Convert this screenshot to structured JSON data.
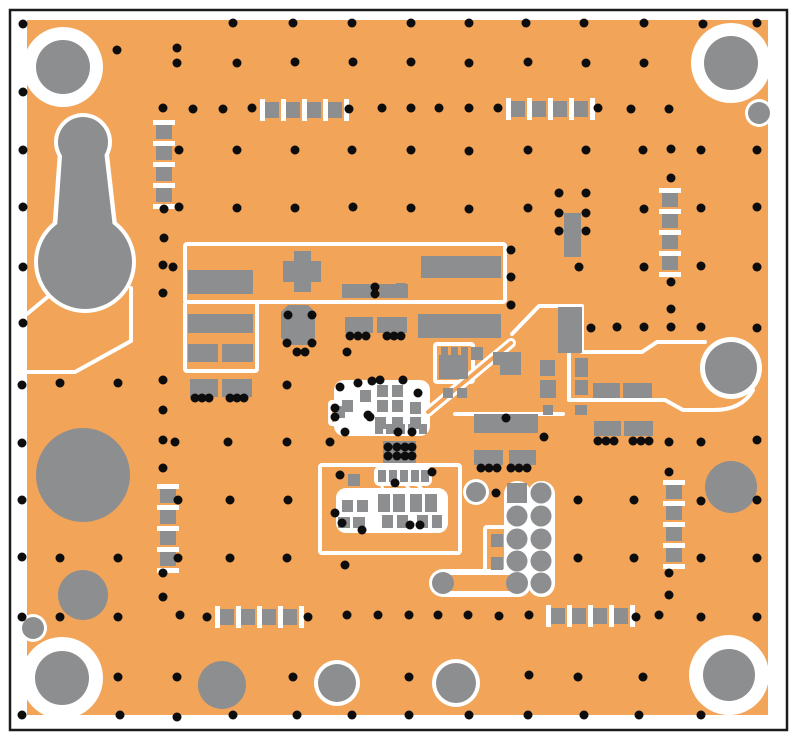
{
  "figure": {
    "kind": "pcb-layout-top-view",
    "width": 796,
    "height": 741
  },
  "colors": {
    "page_bg": "#ffffff",
    "frame": "#1b1b1b",
    "board": "#f2a459",
    "pad": "#8d8e90",
    "silk": "#ffffff",
    "drill": "#0d0d0d"
  },
  "frame": {
    "x": 10,
    "y": 10,
    "w": 777,
    "h": 720
  },
  "board": {
    "x": 27,
    "y": 20,
    "w": 741,
    "h": 695
  },
  "mount_holes": [
    [
      63,
      67,
      27,
      13
    ],
    [
      731,
      63,
      27,
      13
    ],
    [
      62,
      678,
      27,
      14
    ],
    [
      729,
      675,
      26,
      14
    ]
  ],
  "ringed_circles": [
    [
      759,
      113,
      11,
      3
    ],
    [
      33,
      628,
      11,
      3
    ],
    [
      337,
      683,
      19,
      4
    ],
    [
      456,
      683,
      20,
      4
    ],
    [
      476,
      492,
      10,
      3
    ],
    [
      731,
      368,
      26,
      5
    ]
  ],
  "plain_circles": [
    [
      83,
      475,
      47
    ],
    [
      83,
      595,
      25
    ],
    [
      222,
      685,
      24
    ],
    [
      731,
      487,
      26
    ]
  ],
  "teardrop": {
    "small": [
      83,
      142,
      25
    ],
    "big": [
      85,
      262,
      47
    ],
    "stem": "63,142 103,142 113,228 57,228",
    "stem_white": "59,137 107,137 118,233 52,233",
    "tails": [
      "M131,288 L131,341 L75,372 L27,372",
      "M56,290 L27,314"
    ]
  },
  "silk_boxes": [
    [
      185,
      244,
      320,
      58
    ],
    [
      185,
      302,
      72,
      69
    ],
    [
      320,
      465,
      140,
      88
    ],
    [
      485,
      527,
      24,
      51
    ],
    [
      330,
      402,
      22,
      22
    ],
    [
      435,
      344,
      38,
      38
    ]
  ],
  "silk_paths": [
    {
      "d": "M512,334 L539,306 L582,306 L582,352 L642,352 L657,342 L705,342",
      "w": 4
    },
    {
      "d": "M569,354 L569,400 L665,400 L683,410 L714,410 Q742,410 753,390",
      "w": 4
    },
    {
      "d": "M455,414 L563,414",
      "w": 4
    },
    {
      "d": "M381,482 L384,495",
      "w": 3
    },
    {
      "d": "M392,482 L399,495",
      "w": 3
    },
    {
      "d": "M403,482 L415,495",
      "w": 3
    },
    {
      "d": "M414,482 L429,495",
      "w": 3
    }
  ],
  "white_blobs": [
    [
      334,
      380,
      96,
      56,
      10
    ],
    [
      336,
      488,
      112,
      45,
      10
    ],
    [
      374,
      466,
      58,
      20,
      6
    ],
    [
      504,
      481,
      27,
      116,
      13
    ],
    [
      528,
      481,
      27,
      116,
      13
    ]
  ],
  "trace_outline": {
    "d": "M428,412 L511,343",
    "outer": 10,
    "inner": 4
  },
  "dumbbell": {
    "x1": 443,
    "y1": 583,
    "x2": 517,
    "y2": 583,
    "outer": 28,
    "inner": 16,
    "end_r": 11
  },
  "octagon": "288,305 308,305 315,312 315,338 308,345 288,345 281,338 281,312",
  "pads": [
    [
      188,
      270,
      65,
      24
    ],
    [
      283,
      261,
      38,
      21
    ],
    [
      294,
      251,
      17,
      41
    ],
    [
      342,
      284,
      30,
      14
    ],
    [
      379,
      284,
      29,
      14
    ],
    [
      421,
      256,
      80,
      22
    ],
    [
      188,
      314,
      65,
      19
    ],
    [
      188,
      344,
      30,
      18
    ],
    [
      222,
      344,
      31,
      18
    ],
    [
      190,
      379,
      28,
      18
    ],
    [
      222,
      379,
      30,
      18
    ],
    [
      345,
      317,
      28,
      16
    ],
    [
      377,
      317,
      30,
      16
    ],
    [
      418,
      314,
      83,
      24
    ],
    [
      396,
      283,
      10,
      15
    ],
    [
      396,
      318,
      10,
      14
    ],
    [
      439,
      355,
      29,
      24
    ],
    [
      441,
      347,
      7,
      9
    ],
    [
      451,
      347,
      7,
      9
    ],
    [
      461,
      347,
      7,
      9
    ],
    [
      471,
      347,
      12,
      13
    ],
    [
      493,
      352,
      23,
      13
    ],
    [
      558,
      307,
      24,
      46
    ],
    [
      500,
      352,
      21,
      23
    ],
    [
      540,
      360,
      15,
      16
    ],
    [
      540,
      380,
      16,
      18
    ],
    [
      543,
      405,
      10,
      10
    ],
    [
      575,
      358,
      13,
      19
    ],
    [
      575,
      380,
      13,
      15
    ],
    [
      575,
      405,
      12,
      10
    ],
    [
      593,
      383,
      27,
      15
    ],
    [
      623,
      383,
      29,
      15
    ],
    [
      594,
      421,
      27,
      15
    ],
    [
      624,
      421,
      29,
      15
    ],
    [
      474,
      414,
      64,
      19
    ],
    [
      474,
      450,
      29,
      15
    ],
    [
      509,
      450,
      27,
      15
    ],
    [
      383,
      441,
      33,
      22
    ],
    [
      564,
      213,
      17,
      44
    ],
    [
      360,
      390,
      11,
      12
    ],
    [
      377,
      385,
      11,
      12
    ],
    [
      392,
      385,
      11,
      12
    ],
    [
      342,
      400,
      11,
      12
    ],
    [
      377,
      400,
      11,
      12
    ],
    [
      392,
      400,
      11,
      12
    ],
    [
      410,
      402,
      11,
      12
    ],
    [
      375,
      417,
      11,
      12
    ],
    [
      392,
      417,
      11,
      12
    ],
    [
      410,
      417,
      11,
      12
    ],
    [
      334,
      406,
      11,
      12
    ],
    [
      375,
      424,
      8,
      10
    ],
    [
      386,
      424,
      8,
      10
    ],
    [
      397,
      424,
      8,
      10
    ],
    [
      408,
      424,
      8,
      10
    ],
    [
      419,
      424,
      8,
      10
    ],
    [
      378,
      470,
      8,
      12
    ],
    [
      389,
      470,
      8,
      12
    ],
    [
      400,
      470,
      8,
      12
    ],
    [
      411,
      470,
      8,
      12
    ],
    [
      421,
      470,
      8,
      12
    ],
    [
      348,
      474,
      12,
      12
    ],
    [
      342,
      500,
      11,
      12
    ],
    [
      357,
      500,
      11,
      12
    ],
    [
      378,
      494,
      12,
      18
    ],
    [
      393,
      494,
      12,
      18
    ],
    [
      410,
      494,
      12,
      18
    ],
    [
      425,
      494,
      12,
      18
    ],
    [
      382,
      515,
      11,
      13
    ],
    [
      397,
      515,
      11,
      13
    ],
    [
      417,
      515,
      11,
      13
    ],
    [
      432,
      515,
      10,
      13
    ],
    [
      338,
      517,
      12,
      11
    ],
    [
      353,
      517,
      12,
      11
    ],
    [
      491,
      534,
      12,
      13
    ],
    [
      491,
      557,
      12,
      13
    ],
    [
      443,
      388,
      10,
      10
    ],
    [
      457,
      388,
      10,
      10
    ]
  ],
  "chains": [
    {
      "x": 156,
      "y": 120,
      "o": "v"
    },
    {
      "x": 260,
      "y": 102,
      "o": "h"
    },
    {
      "x": 506,
      "y": 101,
      "o": "h"
    },
    {
      "x": 662,
      "y": 188,
      "o": "v"
    },
    {
      "x": 160,
      "y": 484,
      "o": "v"
    },
    {
      "x": 666,
      "y": 480,
      "o": "v"
    },
    {
      "x": 215,
      "y": 609,
      "o": "h"
    },
    {
      "x": 546,
      "y": 608,
      "o": "h"
    }
  ],
  "chain_style": {
    "step": 21,
    "pad_long": 14,
    "pad_short": 16,
    "tick_long": 22,
    "tick_short": 5,
    "count": 4
  },
  "header": {
    "square": [
      507,
      483,
      20,
      20
    ],
    "col_left_x": 517,
    "rows_left": [
      516,
      539,
      561,
      583
    ],
    "col_right_x": 541,
    "rows_right": [
      493,
      516,
      539,
      561,
      583
    ],
    "r": 10.5
  },
  "vias": {
    "r": 4.5,
    "pts": [
      [
        23,
        24
      ],
      [
        233,
        23
      ],
      [
        293,
        23
      ],
      [
        352,
        23
      ],
      [
        411,
        23
      ],
      [
        469,
        23
      ],
      [
        526,
        23
      ],
      [
        584,
        23
      ],
      [
        644,
        23
      ],
      [
        703,
        24
      ],
      [
        757,
        23
      ],
      [
        117,
        50
      ],
      [
        177,
        48
      ],
      [
        177,
        63
      ],
      [
        237,
        63
      ],
      [
        295,
        62
      ],
      [
        353,
        62
      ],
      [
        411,
        62
      ],
      [
        469,
        63
      ],
      [
        528,
        62
      ],
      [
        586,
        63
      ],
      [
        644,
        63
      ],
      [
        23,
        92
      ],
      [
        163,
        108
      ],
      [
        193,
        109
      ],
      [
        223,
        109
      ],
      [
        252,
        108
      ],
      [
        349,
        109
      ],
      [
        382,
        108
      ],
      [
        411,
        108
      ],
      [
        439,
        108
      ],
      [
        469,
        108
      ],
      [
        498,
        108
      ],
      [
        598,
        108
      ],
      [
        631,
        109
      ],
      [
        669,
        109
      ],
      [
        23,
        150
      ],
      [
        179,
        150
      ],
      [
        237,
        150
      ],
      [
        295,
        150
      ],
      [
        352,
        150
      ],
      [
        411,
        150
      ],
      [
        469,
        151
      ],
      [
        528,
        150
      ],
      [
        586,
        150
      ],
      [
        643,
        150
      ],
      [
        671,
        149
      ],
      [
        701,
        150
      ],
      [
        757,
        150
      ],
      [
        671,
        178
      ],
      [
        23,
        207
      ],
      [
        164,
        209
      ],
      [
        179,
        207
      ],
      [
        237,
        208
      ],
      [
        295,
        208
      ],
      [
        353,
        207
      ],
      [
        411,
        208
      ],
      [
        469,
        209
      ],
      [
        528,
        208
      ],
      [
        644,
        209
      ],
      [
        701,
        208
      ],
      [
        757,
        207
      ],
      [
        559,
        193
      ],
      [
        586,
        193
      ],
      [
        559,
        213
      ],
      [
        586,
        213
      ],
      [
        559,
        231
      ],
      [
        586,
        231
      ],
      [
        164,
        238
      ],
      [
        23,
        267
      ],
      [
        163,
        265
      ],
      [
        173,
        267
      ],
      [
        511,
        250
      ],
      [
        579,
        267
      ],
      [
        644,
        267
      ],
      [
        701,
        266
      ],
      [
        757,
        267
      ],
      [
        671,
        282
      ],
      [
        511,
        277
      ],
      [
        163,
        293
      ],
      [
        375,
        287
      ],
      [
        375,
        294
      ],
      [
        511,
        305
      ],
      [
        671,
        309
      ],
      [
        23,
        323
      ],
      [
        288,
        315
      ],
      [
        312,
        315
      ],
      [
        591,
        328
      ],
      [
        617,
        327
      ],
      [
        644,
        327
      ],
      [
        671,
        327
      ],
      [
        701,
        327
      ],
      [
        757,
        328
      ],
      [
        287,
        343
      ],
      [
        297,
        352
      ],
      [
        305,
        352
      ],
      [
        312,
        343
      ],
      [
        347,
        352
      ],
      [
        350,
        336
      ],
      [
        358,
        336
      ],
      [
        366,
        336
      ],
      [
        387,
        336
      ],
      [
        394,
        336
      ],
      [
        401,
        336
      ],
      [
        22,
        385
      ],
      [
        60,
        383
      ],
      [
        118,
        383
      ],
      [
        163,
        380
      ],
      [
        287,
        385
      ],
      [
        340,
        387
      ],
      [
        380,
        380
      ],
      [
        335,
        408
      ],
      [
        335,
        417
      ],
      [
        358,
        383
      ],
      [
        372,
        381
      ],
      [
        403,
        380
      ],
      [
        418,
        393
      ],
      [
        370,
        417
      ],
      [
        345,
        432
      ],
      [
        398,
        432
      ],
      [
        412,
        432
      ],
      [
        163,
        410
      ],
      [
        368,
        415
      ],
      [
        506,
        418
      ],
      [
        544,
        437
      ],
      [
        195,
        398
      ],
      [
        202,
        398
      ],
      [
        209,
        398
      ],
      [
        230,
        398
      ],
      [
        237,
        398
      ],
      [
        244,
        398
      ],
      [
        22,
        443
      ],
      [
        163,
        440
      ],
      [
        175,
        442
      ],
      [
        228,
        442
      ],
      [
        287,
        442
      ],
      [
        330,
        442
      ],
      [
        669,
        442
      ],
      [
        701,
        442
      ],
      [
        757,
        440
      ],
      [
        598,
        441
      ],
      [
        606,
        441
      ],
      [
        614,
        441
      ],
      [
        633,
        441
      ],
      [
        641,
        441
      ],
      [
        649,
        441
      ],
      [
        388,
        447
      ],
      [
        397,
        447
      ],
      [
        405,
        447
      ],
      [
        412,
        447
      ],
      [
        388,
        456
      ],
      [
        397,
        456
      ],
      [
        405,
        456
      ],
      [
        412,
        456
      ],
      [
        340,
        475
      ],
      [
        432,
        472
      ],
      [
        395,
        483
      ],
      [
        342,
        523
      ],
      [
        410,
        525
      ],
      [
        420,
        525
      ],
      [
        362,
        530
      ],
      [
        335,
        513
      ],
      [
        163,
        468
      ],
      [
        669,
        472
      ],
      [
        481,
        468
      ],
      [
        489,
        468
      ],
      [
        497,
        468
      ],
      [
        511,
        468
      ],
      [
        519,
        468
      ],
      [
        527,
        468
      ],
      [
        496,
        493
      ],
      [
        22,
        500
      ],
      [
        178,
        500
      ],
      [
        230,
        500
      ],
      [
        288,
        500
      ],
      [
        578,
        500
      ],
      [
        634,
        500
      ],
      [
        701,
        501
      ],
      [
        757,
        500
      ],
      [
        22,
        557
      ],
      [
        60,
        558
      ],
      [
        118,
        558
      ],
      [
        178,
        558
      ],
      [
        230,
        558
      ],
      [
        287,
        558
      ],
      [
        345,
        565
      ],
      [
        578,
        558
      ],
      [
        634,
        558
      ],
      [
        701,
        558
      ],
      [
        757,
        558
      ],
      [
        163,
        573
      ],
      [
        669,
        573
      ],
      [
        163,
        597
      ],
      [
        669,
        595
      ],
      [
        22,
        617
      ],
      [
        60,
        617
      ],
      [
        118,
        617
      ],
      [
        180,
        615
      ],
      [
        207,
        617
      ],
      [
        308,
        617
      ],
      [
        347,
        615
      ],
      [
        378,
        615
      ],
      [
        409,
        615
      ],
      [
        438,
        615
      ],
      [
        468,
        615
      ],
      [
        499,
        616
      ],
      [
        529,
        615
      ],
      [
        636,
        617
      ],
      [
        659,
        615
      ],
      [
        701,
        617
      ],
      [
        757,
        617
      ],
      [
        118,
        677
      ],
      [
        177,
        677
      ],
      [
        293,
        677
      ],
      [
        409,
        677
      ],
      [
        529,
        675
      ],
      [
        578,
        677
      ],
      [
        643,
        677
      ],
      [
        22,
        715
      ],
      [
        120,
        715
      ],
      [
        177,
        717
      ],
      [
        233,
        715
      ],
      [
        297,
        715
      ],
      [
        352,
        715
      ],
      [
        409,
        715
      ],
      [
        469,
        715
      ],
      [
        528,
        715
      ],
      [
        584,
        715
      ],
      [
        639,
        715
      ],
      [
        701,
        715
      ]
    ]
  }
}
